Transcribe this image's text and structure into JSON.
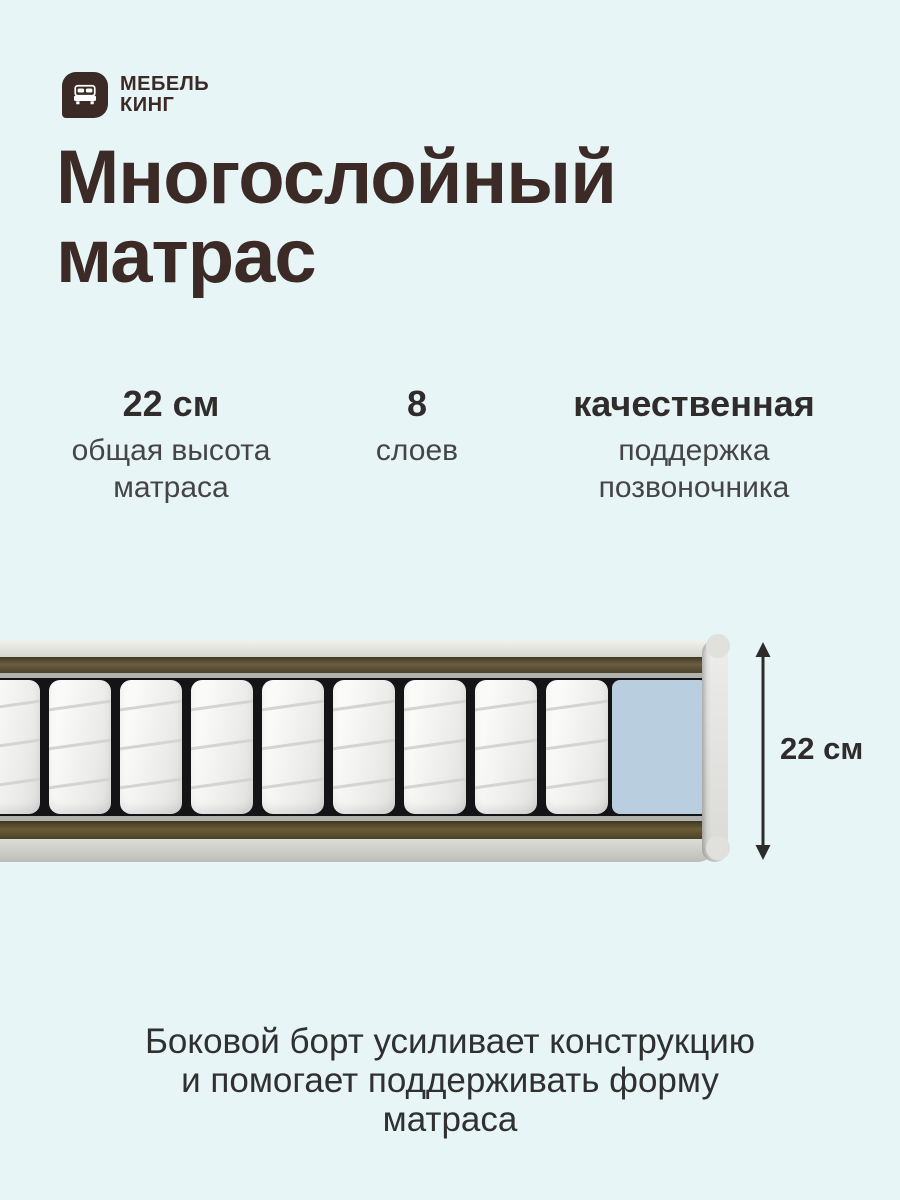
{
  "brand": {
    "line1": "МЕБЕЛЬ",
    "line2": "КИНГ",
    "logo_icon": "bed-icon"
  },
  "title": {
    "line1": "Многослойный",
    "line2": "матрас"
  },
  "stats": [
    {
      "value": "22 см",
      "label": "общая высота матраса"
    },
    {
      "value": "8",
      "label": "слоев"
    },
    {
      "value": "качественная",
      "label": "поддержка позвоночника"
    }
  ],
  "diagram": {
    "height_label": "22 см",
    "spring_count": 9,
    "spring_pitch_px": 71,
    "spring_first_left_px": -22,
    "arrow_icon": "arrow-updown-icon"
  },
  "footer": {
    "lines": [
      "Боковой борт усиливает конструкцию",
      "и помогает поддерживать форму",
      "матраса"
    ]
  },
  "colors": {
    "background": "#e8f5f7",
    "brand_brown": "#3b2a25",
    "text_dark": "#2f2c2b",
    "text_gray": "#454545",
    "felt_brown": "#6b5f42",
    "spring_bg": "#141416",
    "spring_white": "#fafbf9",
    "foam_blue": "#b9cfe0",
    "edge_gray": "#e0e1dd"
  }
}
